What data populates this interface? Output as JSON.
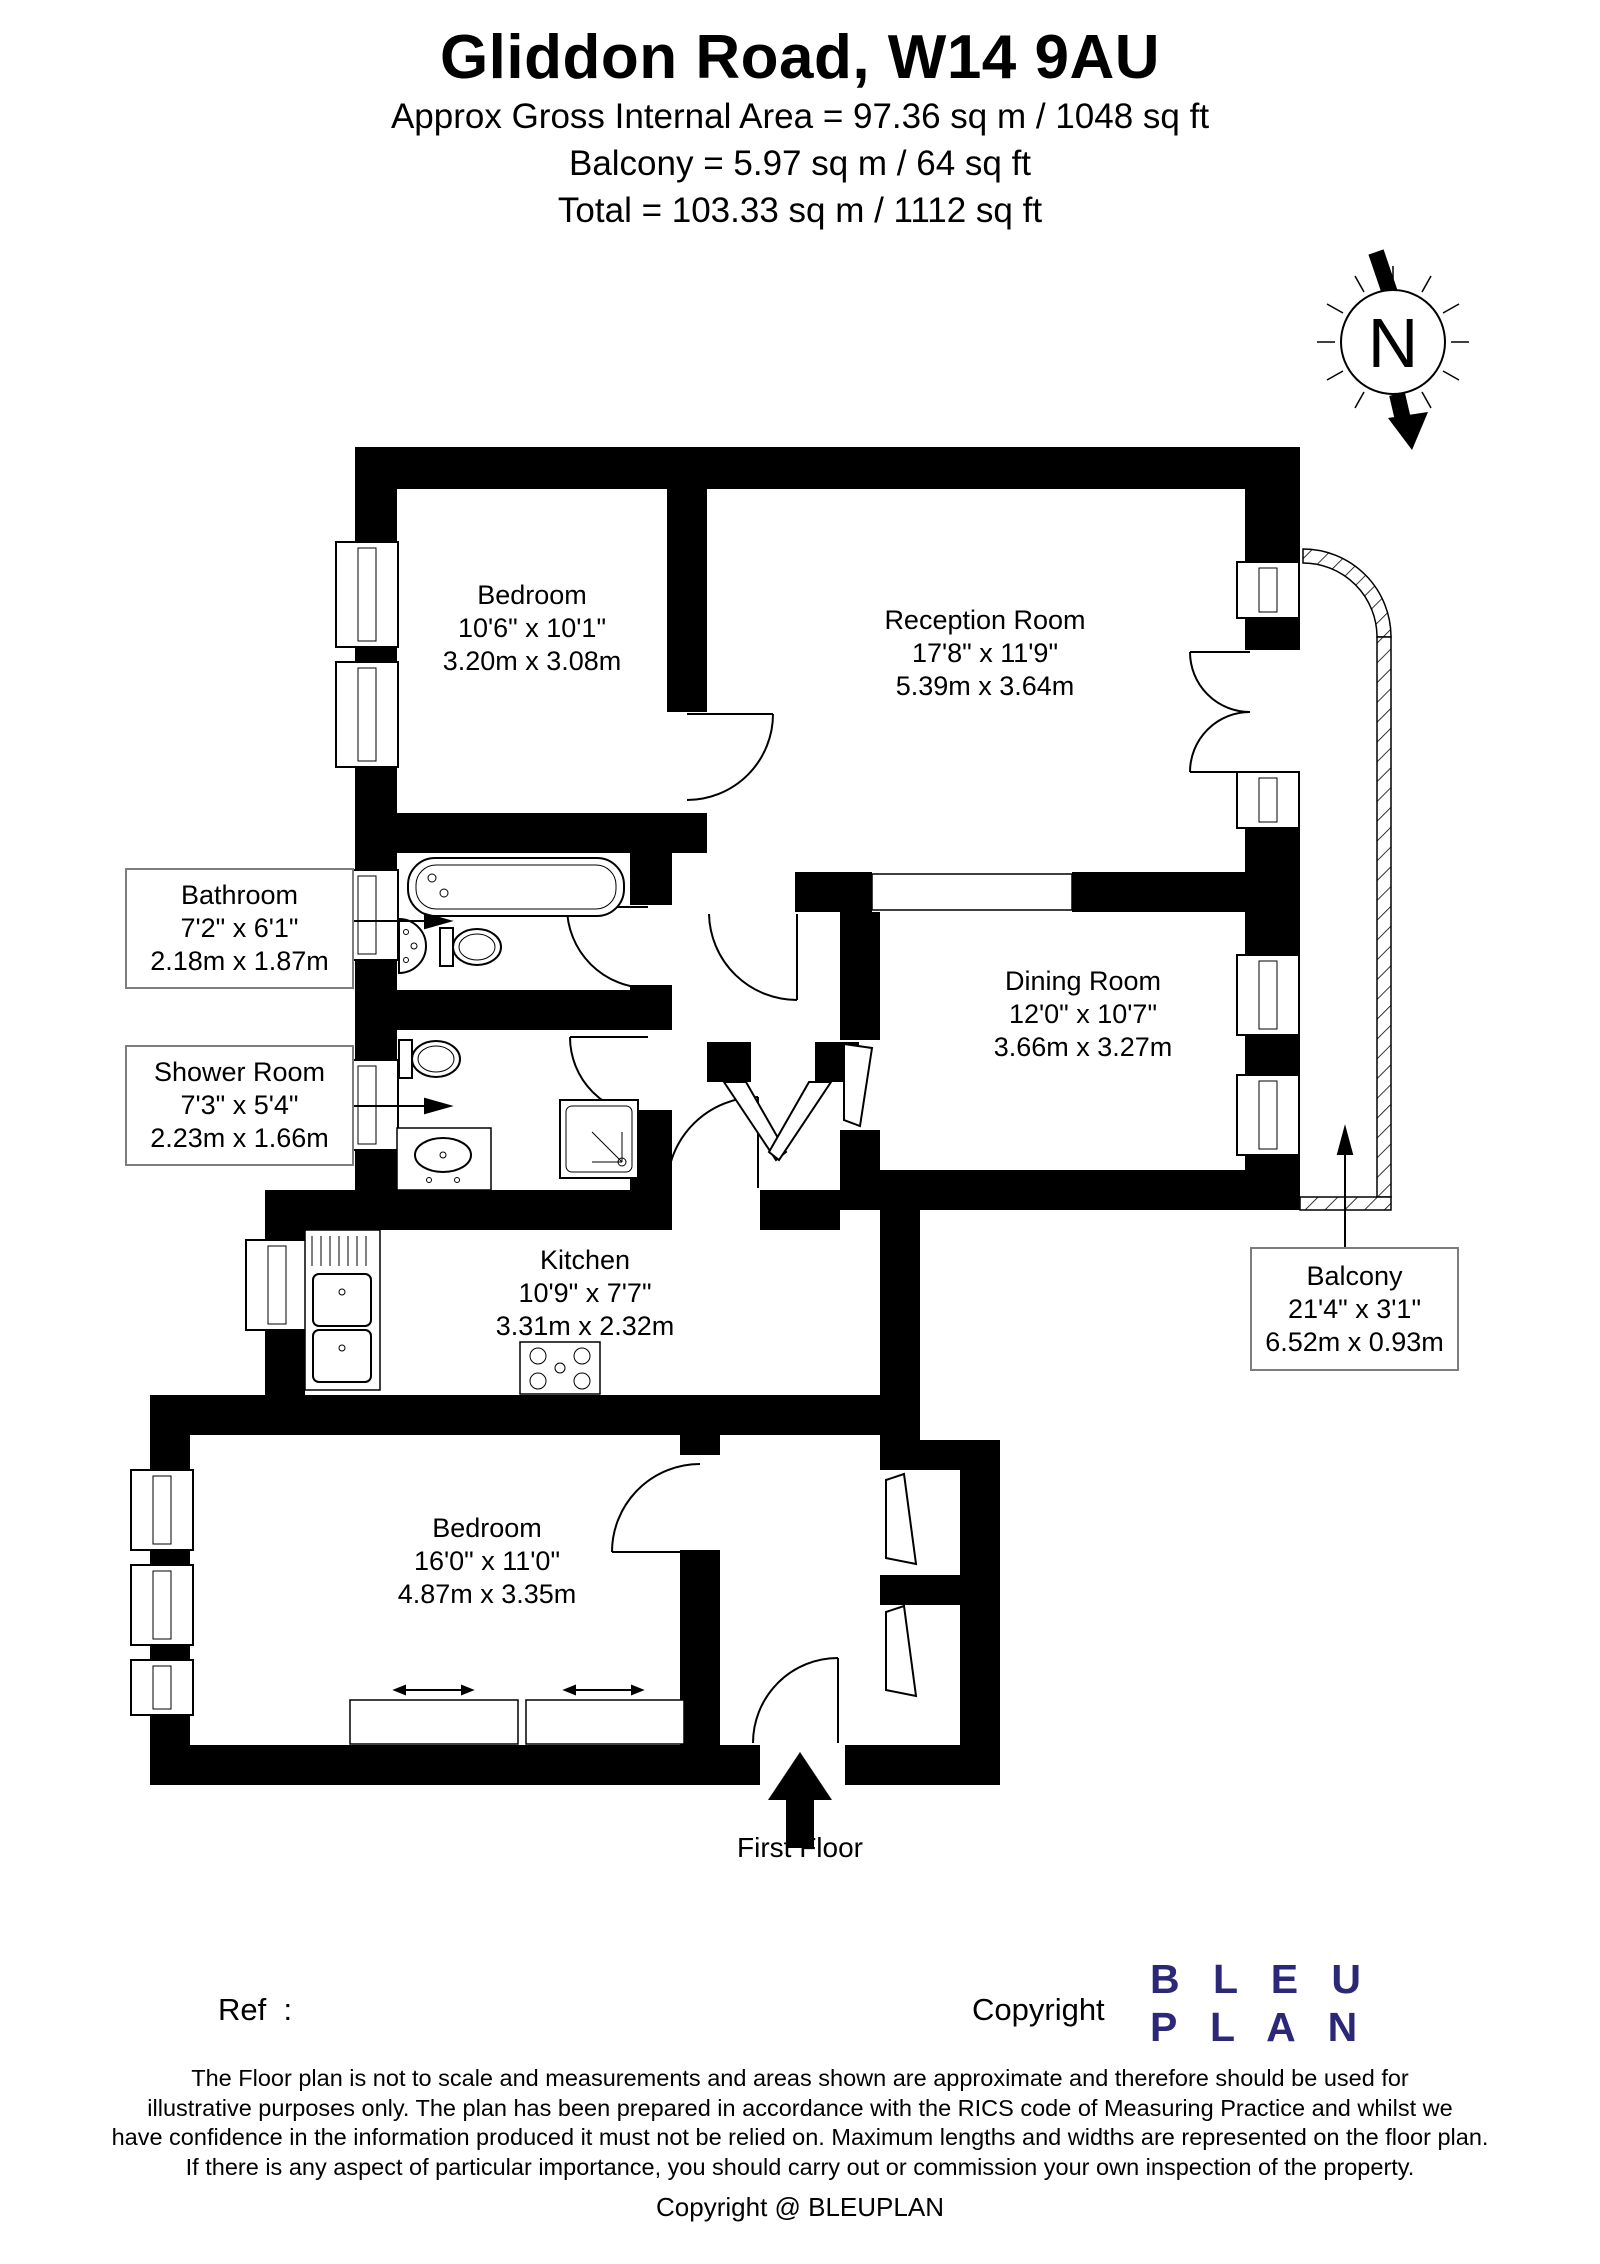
{
  "header": {
    "title": "Gliddon Road, W14 9AU",
    "area_lines": [
      "Approx Gross Internal Area = 97.36 sq m / 1048 sq ft",
      "Balcony = 5.97 sq m / 64 sq ft",
      "Total = 103.33 sq m / 1112 sq ft"
    ]
  },
  "compass": {
    "label": "N"
  },
  "rooms": [
    {
      "name": "Bedroom",
      "imperial": "10'6\" x 10'1\"",
      "metric": "3.20m x 3.08m"
    },
    {
      "name": "Reception Room",
      "imperial": "17'8\" x 11'9\"",
      "metric": "5.39m x 3.64m"
    },
    {
      "name": "Dining Room",
      "imperial": "12'0\" x 10'7\"",
      "metric": "3.66m x 3.27m"
    },
    {
      "name": "Kitchen",
      "imperial": "10'9\" x 7'7\"",
      "metric": "3.31m x 2.32m"
    },
    {
      "name": "Bedroom",
      "imperial": "16'0\" x 11'0\"",
      "metric": "4.87m x 3.35m"
    }
  ],
  "callouts": [
    {
      "name": "Bathroom",
      "imperial": "7'2\" x 6'1\"",
      "metric": "2.18m x 1.87m"
    },
    {
      "name": "Shower Room",
      "imperial": "7'3\" x 5'4\"",
      "metric": "2.23m x 1.66m"
    },
    {
      "name": "Balcony",
      "imperial": "21'4\" x 3'1\"",
      "metric": "6.52m x 0.93m"
    }
  ],
  "floor_label": "First Floor",
  "footer": {
    "ref_label": "Ref  :",
    "copyright_label": "Copyright",
    "logo_line1": "B L E U",
    "logo_line2": "P L A N",
    "logo_color": "#2b2878",
    "disclaimer": [
      "The Floor plan is not to scale and measurements and areas shown are approximate and therefore should be used for",
      "illustrative purposes only. The plan has been prepared in accordance with the RICS code of Measuring Practice and whilst we",
      "have confidence in the information produced it must not be relied on. Maximum lengths and widths are represented on the floor plan.",
      "If there is any aspect of particular importance, you should carry out or commission your own inspection of the property."
    ],
    "copyright_line": "Copyright @ BLEUPLAN"
  }
}
